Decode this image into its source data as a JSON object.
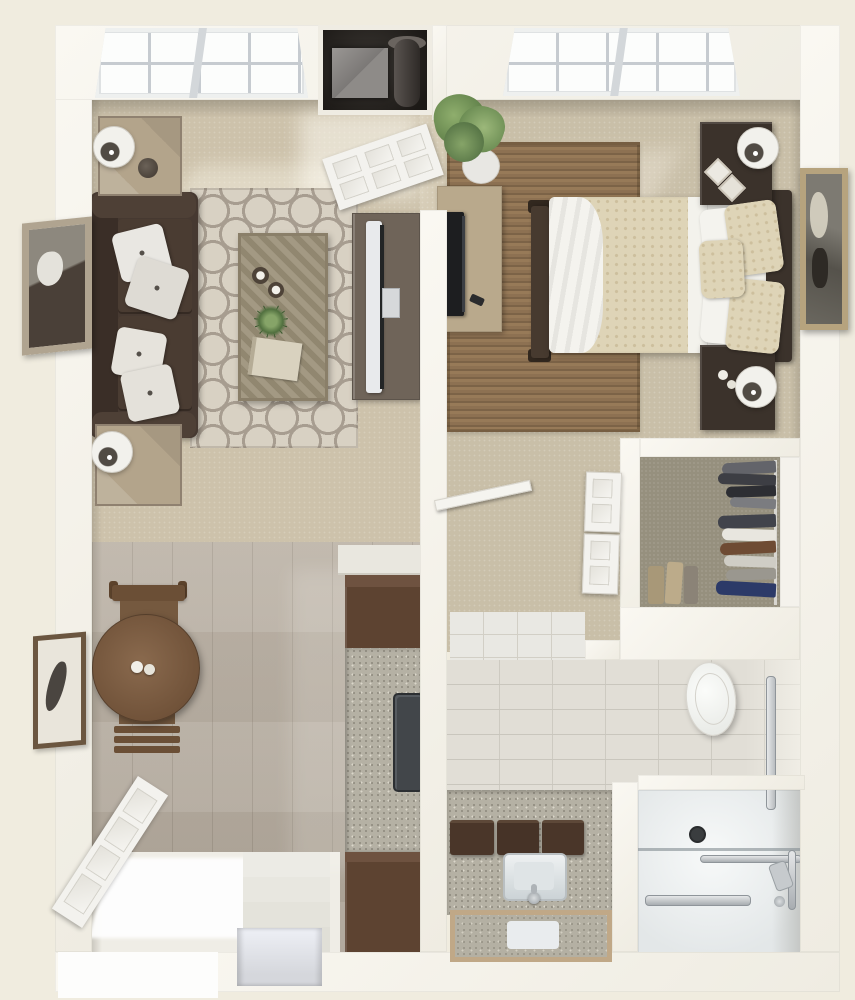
{
  "meta": {
    "title": "3D top-down floor plan — one-bedroom, one-bath apartment",
    "view": "bird's-eye 3D render",
    "text_content": "none (image contains no visible text)"
  },
  "colors": {
    "bg": "#f0ecdf",
    "wall": "#f7f5ee",
    "carpetLiving": "#cdc2ab",
    "carpetBed": "#c9bfa8",
    "wood": "#b7ada0",
    "rugBase": "#d8d1c3",
    "rugLine": "#a79d90",
    "jute": "#8d7152",
    "sofa": "#463931",
    "pillow": "#e9e7e2",
    "tableWood": "#b3a48b",
    "coffeeTable": "#9a8f77",
    "console": "#6f6459",
    "door": "#f3f2ee",
    "niche": "#26211d",
    "tile": "#e1ded6",
    "grout": "#c9c6bd",
    "counter": "#b5b1a4",
    "cabinet": "#5d4331",
    "cabinetLight": "#6e5240",
    "diningTable": "#7c5c42",
    "chair": "#6b4f36",
    "bedCover": "#ded4b7",
    "bedDot": "#cdbf9d",
    "bedWhite": "#f1f0ea",
    "espresso": "#3b322b",
    "mirrorGold": "#b6a37e",
    "closetFloor": "#96907e",
    "shower": "#f4f6f6",
    "chrome": "#9aa0a6",
    "appliance": "#42464a"
  },
  "rooms": {
    "living_room": {
      "name": "Living Room",
      "floor": "beige carpet",
      "furniture": [
        "brown sofa with four light pillows",
        "trellis-pattern area rug",
        "coffee table with plant, candles and book",
        "two weathered-wood end tables with drum lamps",
        "media console with flat TV",
        "wall mirror in rustic frame",
        "angled picture windows",
        "open white panel door",
        "utility niche with vase"
      ]
    },
    "bedroom": {
      "name": "Bedroom",
      "floor": "beige carpet",
      "furniture": [
        "bed with cream patterned comforter and white sheets",
        "dark headboard and footboard",
        "two espresso nightstands with drum lamps",
        "dresser with flat TV",
        "jute area rug",
        "leaning gold-framed mirror",
        "potted plant",
        "angled picture windows"
      ]
    },
    "hallway": {
      "name": "Hallway",
      "floor": "carpet",
      "furniture": [
        "open door",
        "bifold closet doors",
        "tile threshold to bathroom"
      ]
    },
    "walk_in_closet": {
      "name": "Walk-in Closet",
      "furniture": [
        "hanging clothes in grays, white, brown and navy",
        "white shelf band",
        "folded garments"
      ]
    },
    "bathroom": {
      "name": "Bathroom",
      "floor": "subway tile",
      "furniture": [
        "toilet",
        "granite vanity with sink and faucet",
        "three dark storage boxes",
        "wood-framed mirror",
        "walk-in shower with glass panel",
        "drain",
        "grab bars",
        "hand shower set"
      ]
    },
    "dining_area": {
      "name": "Dining Area",
      "floor": "light wood planks",
      "furniture": [
        "round wood dining table with salt and pepper",
        "two wood chairs",
        "framed botanical print"
      ]
    },
    "kitchen": {
      "name": "Kitchen",
      "furniture": [
        "dark brown upper cabinet",
        "speckled counter recess with dark appliance",
        "dark brown lower cabinet",
        "white counter return"
      ]
    },
    "entry": {
      "name": "Entry",
      "furniture": [
        "open white entry door",
        "bright door mat",
        "four descending steps",
        "lower landing"
      ]
    }
  }
}
